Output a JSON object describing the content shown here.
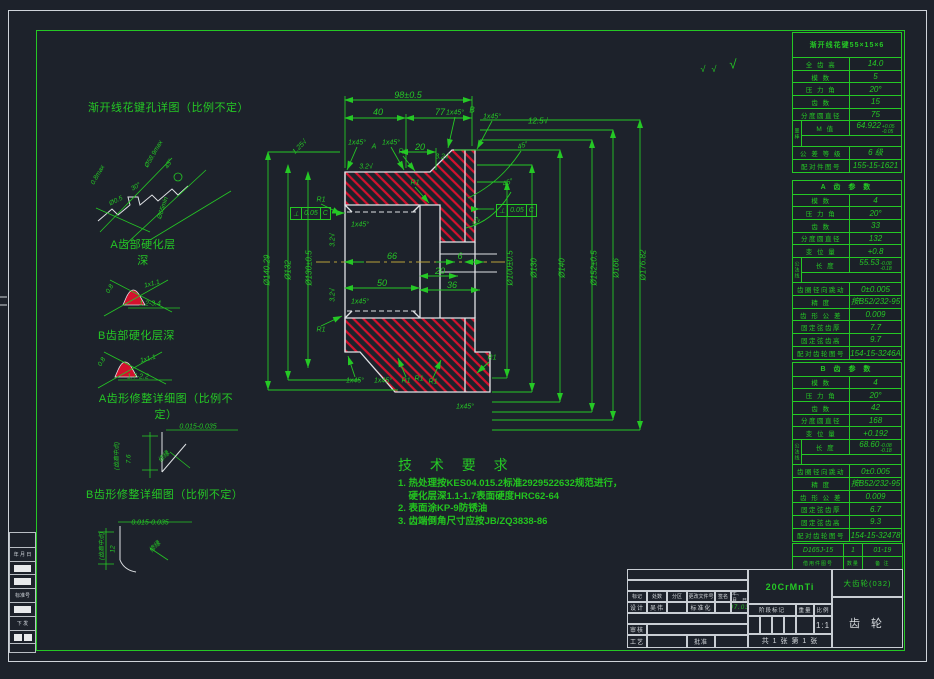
{
  "colors": {
    "bg": "#1d222b",
    "green": "#25c825",
    "white_line": "#e0e3e6",
    "hatch_red": "#d4112e",
    "center_yellow": "#b9a23a"
  },
  "left_details": {
    "t1": "渐开线花键孔详图（比例不定）",
    "t2": "A齿部硬化层\n深",
    "t3": "B齿部硬化层深",
    "t4": "A齿形修整详细图（比例不\n定）",
    "t5": "B齿形修整详细图（比例不定）"
  },
  "tech_req": {
    "title": "技 术 要 求",
    "l1": "1. 热处理按KES04.015.2标准2929522632规范进行，",
    "l2": "    硬化层深1.1-1.7表面硬度HRC62-64",
    "l3": "2. 表面涂KP-9防锈油",
    "l4": "3. 齿端倒角尺寸应按JB/ZQ3838-86"
  },
  "gdt1": {
    "sym": "⊥",
    "val": "0.05",
    "ref": "C"
  },
  "gdt2": {
    "sym": "⊥",
    "val": "0.05",
    "ref": "C"
  },
  "tables": {
    "spline": {
      "title": "渐开线花键55×15×6",
      "rows": [
        {
          "l": "全 齿 高",
          "v": "14.0"
        },
        {
          "l": "模  数",
          "v": "5"
        },
        {
          "l": "压 力 角",
          "v": "20°"
        },
        {
          "l": "齿  数",
          "v": "15"
        },
        {
          "l": "分度圆直径",
          "v": "75"
        },
        {
          "side": "量棒",
          "l": "M 值",
          "v": "64.922",
          "sup": "+0.05",
          "sub": "-0.05"
        },
        {
          "l": "公 差 等 级",
          "v": "6 级"
        },
        {
          "l": "配对件图号",
          "v": "155-15-1621"
        }
      ]
    },
    "gear_a": {
      "title": "A 齿 参 数",
      "rows": [
        {
          "l": "模  数",
          "v": "4"
        },
        {
          "l": "压 力 角",
          "v": "20°"
        },
        {
          "l": "齿  数",
          "v": "33"
        },
        {
          "l": "分度圆直径",
          "v": "132"
        },
        {
          "l": "变 位 量",
          "v": "+0.8"
        },
        {
          "side": "公法线",
          "l": "长 度",
          "v": "55.53",
          "sup": "-0.08",
          "sub": "-0.18"
        },
        {
          "l": "齿圈径向跳动",
          "v": "0±0.005"
        },
        {
          "l": "精  度",
          "v": "按B52/232-95"
        },
        {
          "l": "齿 形 公 差",
          "v": "0.009"
        },
        {
          "l": "固定弦齿厚",
          "v": "7.7"
        },
        {
          "l": "固定弦齿高",
          "v": "9.7"
        },
        {
          "l": "配对齿轮图号",
          "v": "154-15-3246A"
        }
      ]
    },
    "gear_b": {
      "title": "B 齿 参 数",
      "rows": [
        {
          "l": "模  数",
          "v": "4"
        },
        {
          "l": "压 力 角",
          "v": "20°"
        },
        {
          "l": "齿  数",
          "v": "42"
        },
        {
          "l": "分度圆直径",
          "v": "168"
        },
        {
          "l": "变 位 量",
          "v": "+0.192"
        },
        {
          "side": "公法线",
          "l": "长 度",
          "v": "68.60",
          "sup": "-0.08",
          "sub": "-0.18"
        },
        {
          "l": "齿圈径向跳动",
          "v": "0±0.005"
        },
        {
          "l": "精  度",
          "v": "按B52/232-95"
        },
        {
          "l": "齿 形 公 差",
          "v": "0.009"
        },
        {
          "l": "固定弦齿厚",
          "v": "6.7"
        },
        {
          "l": "固定弦齿高",
          "v": "9.3"
        },
        {
          "l": "配对齿轮图号",
          "v": "154-15-32478"
        }
      ]
    }
  },
  "borrow": {
    "values": [
      "D165J-15",
      "1",
      "01-19"
    ],
    "labels": [
      "借用件图号",
      "数量",
      "备 注"
    ]
  },
  "title_block": {
    "material": "20CrMnTi",
    "drawing_no": "大齿轮(032)",
    "part_name": "齿 轮",
    "row_headers": [
      "标记",
      "处数",
      "分区",
      "更改文件号",
      "签名",
      "年、月、日"
    ],
    "design_label": "设计",
    "design_name": "吴伟",
    "standard_label": "标准化",
    "date": "07.03",
    "audit_label": "审核",
    "process_label": "工艺",
    "approve_label": "批准",
    "stage_label": "阶段标记",
    "weight_label": "重量",
    "scale_label": "比例",
    "scale": "1:1",
    "sheets": "共 1 张 第 1 张"
  },
  "strip": {
    "cells": [
      {
        "h": 16,
        "t": ""
      },
      {
        "h": 14,
        "t": "年 月 日"
      },
      {
        "h": 13,
        "b": 1
      },
      {
        "h": 14,
        "b": 1
      },
      {
        "h": 14,
        "t": "标准号"
      },
      {
        "h": 14,
        "b": 1
      },
      {
        "h": 14,
        "t": "下 发"
      },
      {
        "h": 13,
        "b2": 1
      },
      {
        "h": 9,
        "t": ""
      }
    ]
  },
  "annotations": [
    {
      "t": "98±0.5",
      "x": 408,
      "y": 95,
      "s": 9
    },
    {
      "t": "40",
      "x": 378,
      "y": 112,
      "s": 9
    },
    {
      "t": "77",
      "x": 440,
      "y": 112,
      "s": 9
    },
    {
      "t": "20",
      "x": 420,
      "y": 147,
      "s": 9
    },
    {
      "t": "1x45°",
      "x": 357,
      "y": 143,
      "s": 7
    },
    {
      "t": "A",
      "x": 374,
      "y": 147,
      "s": 7
    },
    {
      "t": "1x45°",
      "x": 391,
      "y": 143,
      "s": 7
    },
    {
      "t": "R1",
      "x": 403,
      "y": 152,
      "s": 7
    },
    {
      "t": "R1",
      "x": 415,
      "y": 183,
      "s": 7
    },
    {
      "t": "3.2√",
      "x": 366,
      "y": 167,
      "s": 7
    },
    {
      "t": "1x45°",
      "x": 455,
      "y": 113,
      "s": 7
    },
    {
      "t": "B",
      "x": 472,
      "y": 110,
      "s": 8
    },
    {
      "t": "1x45°",
      "x": 492,
      "y": 117,
      "s": 7
    },
    {
      "t": "3.2√",
      "x": 442,
      "y": 157,
      "s": 7
    },
    {
      "t": "12.5√",
      "x": 538,
      "y": 121,
      "s": 8
    },
    {
      "t": "45°",
      "x": 523,
      "y": 146,
      "r": -20,
      "s": 7
    },
    {
      "t": "45°",
      "x": 508,
      "y": 183,
      "r": -20,
      "s": 7
    },
    {
      "t": "1.25√",
      "x": 300,
      "y": 147,
      "r": -45,
      "s": 7
    },
    {
      "t": "Ø140.29",
      "x": 267,
      "y": 270,
      "r": -90,
      "s": 8
    },
    {
      "t": "Ø132",
      "x": 288,
      "y": 270,
      "r": -90,
      "s": 8
    },
    {
      "t": "Ø130±0.5",
      "x": 309,
      "y": 268,
      "r": -90,
      "s": 8
    },
    {
      "t": "1x45°",
      "x": 360,
      "y": 225,
      "s": 7
    },
    {
      "t": "1x45°",
      "x": 360,
      "y": 302,
      "s": 7
    },
    {
      "t": "3.2√",
      "x": 333,
      "y": 240,
      "r": -90,
      "s": 7
    },
    {
      "t": "3.2√",
      "x": 333,
      "y": 295,
      "r": -90,
      "s": 7
    },
    {
      "t": "R1",
      "x": 321,
      "y": 200,
      "s": 7
    },
    {
      "t": "R1",
      "x": 321,
      "y": 330,
      "s": 7
    },
    {
      "t": "50",
      "x": 382,
      "y": 283,
      "s": 9
    },
    {
      "t": "66",
      "x": 392,
      "y": 256,
      "s": 9
    },
    {
      "t": "6",
      "x": 460,
      "y": 256,
      "s": 9
    },
    {
      "t": "20",
      "x": 440,
      "y": 271,
      "s": 9
    },
    {
      "t": "36",
      "x": 452,
      "y": 285,
      "s": 9
    },
    {
      "t": "R2",
      "x": 477,
      "y": 222,
      "r": -60,
      "s": 7
    },
    {
      "t": "Ø100±0.5",
      "x": 510,
      "y": 268,
      "r": -90,
      "s": 8
    },
    {
      "t": "Ø130",
      "x": 534,
      "y": 268,
      "r": -90,
      "s": 8
    },
    {
      "t": "Ø140",
      "x": 562,
      "y": 268,
      "r": -90,
      "s": 8
    },
    {
      "t": "Ø152±0.5",
      "x": 594,
      "y": 268,
      "r": -90,
      "s": 8
    },
    {
      "t": "Ø166",
      "x": 616,
      "y": 268,
      "r": -90,
      "s": 8
    },
    {
      "t": "Ø176.82",
      "x": 643,
      "y": 265,
      "r": -90,
      "s": 8
    },
    {
      "t": "1x45°",
      "x": 355,
      "y": 381,
      "s": 7
    },
    {
      "t": "1x45°",
      "x": 383,
      "y": 381,
      "s": 7
    },
    {
      "t": "R1",
      "x": 406,
      "y": 381,
      "s": 7
    },
    {
      "t": "R1",
      "x": 419,
      "y": 379,
      "s": 7
    },
    {
      "t": "R1",
      "x": 433,
      "y": 382,
      "s": 7
    },
    {
      "t": "R1",
      "x": 492,
      "y": 358,
      "s": 7
    },
    {
      "t": "1x45°",
      "x": 465,
      "y": 407,
      "s": 7
    },
    {
      "t": "√",
      "x": 703,
      "y": 69,
      "s": 9
    },
    {
      "t": "√",
      "x": 714,
      "y": 69,
      "s": 9
    },
    {
      "t": "√",
      "x": 733,
      "y": 64,
      "s": 13
    },
    {
      "t": "0.8max",
      "x": 98,
      "y": 175,
      "r": -60,
      "s": 6.5
    },
    {
      "t": "Ø58.9max",
      "x": 154,
      "y": 154,
      "r": -60,
      "s": 6.5
    },
    {
      "t": "45°",
      "x": 169,
      "y": 164,
      "r": -60,
      "s": 6.5
    },
    {
      "t": "30°",
      "x": 136,
      "y": 187,
      "r": -30,
      "s": 6.5
    },
    {
      "t": "Ø0.5",
      "x": 116,
      "y": 201,
      "r": -25,
      "s": 6.5
    },
    {
      "t": "Ø65min",
      "x": 163,
      "y": 208,
      "r": -72,
      "s": 6.5
    },
    {
      "t": "0.8",
      "x": 110,
      "y": 289,
      "r": -60,
      "s": 6.5
    },
    {
      "t": "1x1.1",
      "x": 152,
      "y": 284,
      "r": -15,
      "s": 6.5
    },
    {
      "t": "1.2-3.4",
      "x": 150,
      "y": 304,
      "s": 7
    },
    {
      "t": "0.8",
      "x": 102,
      "y": 362,
      "r": -60,
      "s": 6.5
    },
    {
      "t": "1x1.1",
      "x": 148,
      "y": 359,
      "r": -15,
      "s": 6.5
    },
    {
      "t": "1.7-2.2",
      "x": 138,
      "y": 377,
      "s": 7
    },
    {
      "t": "0.015-0.035",
      "x": 198,
      "y": 427,
      "s": 7
    },
    {
      "t": "(齿高中点)",
      "x": 116,
      "y": 456,
      "r": -90,
      "s": 6
    },
    {
      "t": "7.6",
      "x": 129,
      "y": 459,
      "r": -90,
      "s": 6.5
    },
    {
      "t": "修缘",
      "x": 163,
      "y": 456,
      "r": -45,
      "s": 6.5
    },
    {
      "t": "0.015-0.035",
      "x": 150,
      "y": 523,
      "s": 7
    },
    {
      "t": "(齿高中点)",
      "x": 101,
      "y": 546,
      "r": -90,
      "s": 6
    },
    {
      "t": "12",
      "x": 113,
      "y": 549,
      "r": -90,
      "s": 6.5
    },
    {
      "t": "修缘",
      "x": 154,
      "y": 546,
      "r": -45,
      "s": 6.5
    }
  ]
}
